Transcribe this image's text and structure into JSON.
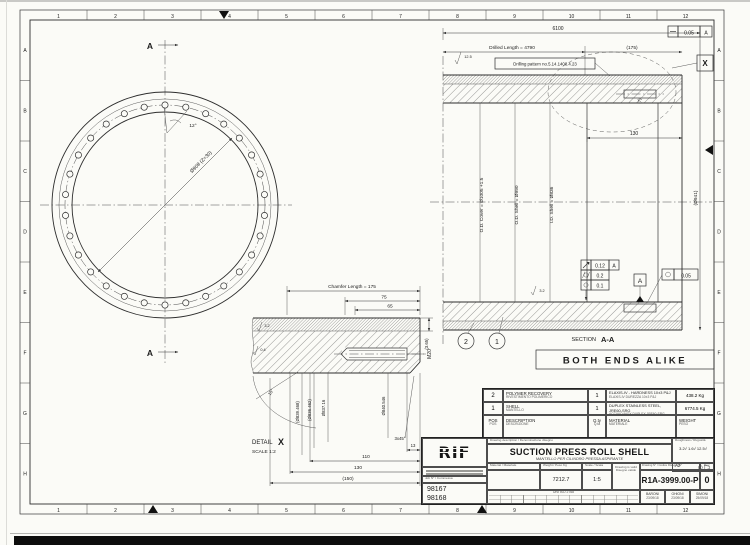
{
  "border": {
    "cols": [
      "1",
      "2",
      "3",
      "4",
      "5",
      "6",
      "7",
      "8",
      "9",
      "10",
      "11",
      "12"
    ],
    "rows": [
      "A",
      "B",
      "C",
      "D",
      "E",
      "F",
      "G",
      "H"
    ]
  },
  "circle_view": {
    "holes": 30,
    "angle_label": "12°",
    "bolt_circle_label": "Ø908 (Z=30)",
    "section_letter": "A"
  },
  "section_view": {
    "overall": "6100",
    "overall_fcf": {
      "symbol": "straightness",
      "value": "0.05",
      "datum": "A"
    },
    "drilled": "Drilled Length = 4790",
    "offset": "(175)",
    "pattern_note": "Drilling pattern no.5.14.1408.4.23",
    "detail_marker": "X",
    "end_width": "130",
    "od_cover": "O.D. Cover = Ø1005 +1.5",
    "od_shell": "O.D. Shell = Ø990",
    "id_shell": "I.D. Shell = Ø836",
    "dia_out": "(Ø941)",
    "hole_ref": "(7)",
    "rough_left": "12.5",
    "rough_mid": "3.2",
    "fcf": [
      {
        "symbol": "circular-runout",
        "value": "0.12",
        "datum": "A"
      },
      {
        "symbol": "cylindricity",
        "value": "0.2"
      },
      {
        "symbol": "roundness",
        "value": "0.1"
      }
    ],
    "fcf_round": {
      "symbol": "roundness",
      "value": "0.05"
    },
    "datum": "A",
    "balloon_shell": "1",
    "balloon_cover": "2",
    "caption": "SECTION",
    "caption_ref": "A-A",
    "note": "BOTH ENDS ALIKE"
  },
  "detail_view": {
    "caption": "DETAIL",
    "ref": "X",
    "scale": "SCALE 1:2",
    "chamfer_length": "Chamfer Length = 175",
    "dim75": "75",
    "dim65": "65",
    "thread": "M20",
    "cover_thk": "(3.65)",
    "angle": "15°",
    "rough_cover": "3.2",
    "rough_bore": "0.4",
    "chamfer": "3x45°",
    "dim13": "13",
    "dim110": "110",
    "dim130": "130",
    "dim150": "(150)",
    "dia1": "(Ø839.468)",
    "dia2": "(Ø836.462)",
    "dia3": "Ø837.16",
    "dia4": "Ø840.546"
  },
  "bom": {
    "header": {
      "pos_en": "POS",
      "pos_it": "POS",
      "desc_en": "DESCRIPTION",
      "desc_it": "DESCRIZIONE",
      "qty_en": "Q.ty",
      "qty_it": "Q.tà",
      "mat_en": "MATERIAL",
      "mat_it": "MATERIALE",
      "wt_en": "WEIGHT",
      "wt_it": "PESO"
    },
    "rows": [
      {
        "pos": "2",
        "desc_en": "POLYMER RECOVERY",
        "desc_it": "RIVESTIMENTO POLIMERICO",
        "qty": "1",
        "mat_en": "ELAXIS-IV - HARDNESS 10±3 P&J",
        "mat_it": "ELAXIS-IV DUREZZA 10±3 P&J",
        "weight": "438.2 Kg"
      },
      {
        "pos": "1",
        "desc_en": "SHELL",
        "desc_it": "MANTELLO",
        "qty": "1",
        "mat_en": "DUPLEX STAINLESS STEEL, JRE60-SRG",
        "mat_it": "ACCIAIO INOX DUPLEX JRE60-SRG",
        "weight": "6774.5 Kg"
      }
    ]
  },
  "title_block": {
    "logo": "RIF",
    "desc_label": "Drawing description / Denominazione disegno",
    "title_en": "SUCTION PRESS ROLL SHELL",
    "title_it": "MANTELLO PER CILINDRO PRESSA ASPIRANTE",
    "rough_label": "Roughness / Rugosità",
    "roughness": [
      "3.2",
      "1.6",
      "12.5"
    ],
    "sheet": "A2 420x594",
    "material_label": "Material / Materiale",
    "material": "",
    "weight_label": "Weight / Peso Kg",
    "weight": "7212.7",
    "scale_label": "Scale / Scala",
    "scale": "1:5",
    "valid_en": "Drawing is valid",
    "valid_it": "Disegno valido",
    "dwg_label": "Drawing N° / Codice Disegno N°",
    "rev_label": "Rev.",
    "dwg_no": "R1A-3999.00-P",
    "rev": "0",
    "job_label": "Job N° / Commessa",
    "job_numbers": [
      "98167",
      "98168"
    ],
    "tol_note": "UNI ISO 2768",
    "sign": [
      {
        "name": "BARONI",
        "date": "23/09/18"
      },
      {
        "name": "GHIONI",
        "date": "23/09/18"
      },
      {
        "name": "SIMONI",
        "date": "25/09/18"
      }
    ]
  }
}
